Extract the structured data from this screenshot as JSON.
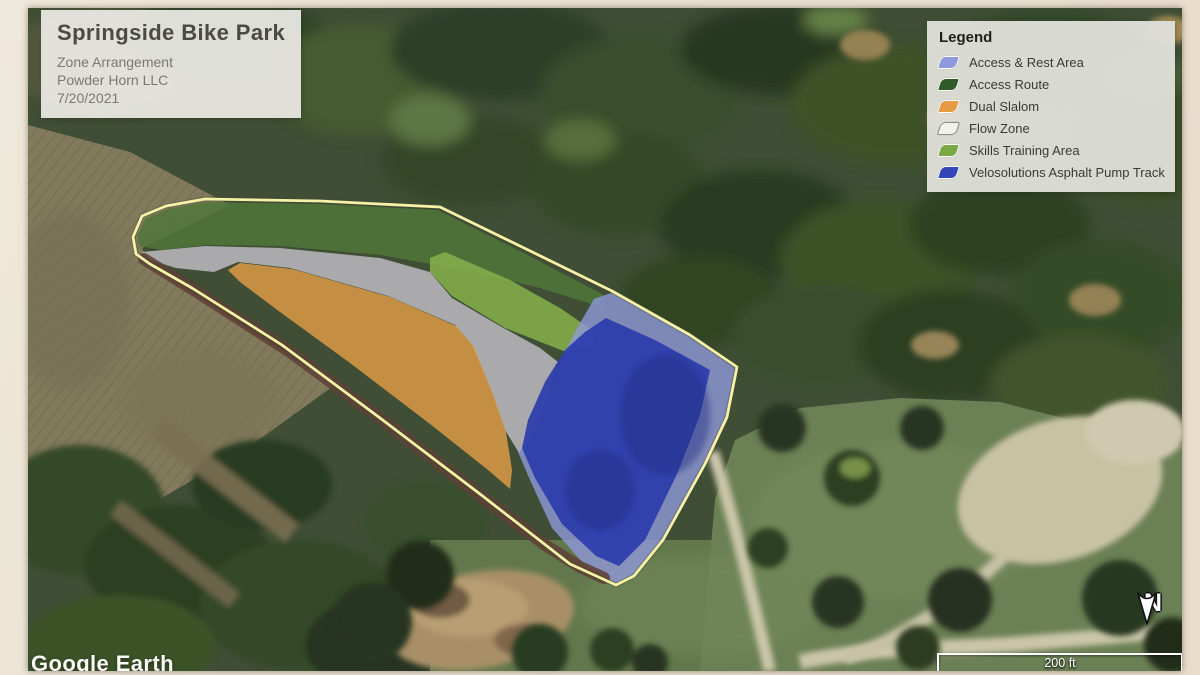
{
  "title_box": {
    "title": "Springside Bike Park",
    "lines": [
      "Zone Arrangement",
      "Powder Horn LLC",
      "7/20/2021"
    ]
  },
  "legend": {
    "title": "Legend",
    "items": [
      {
        "label": "Access & Rest Area",
        "color": "#8e99dd",
        "border": "#ffffff"
      },
      {
        "label": "Access Route",
        "color": "#2f5b28",
        "border": "#ffffff"
      },
      {
        "label": "Dual Slalom",
        "color": "#e59a43",
        "border": "#ffffff"
      },
      {
        "label": "Flow Zone",
        "color": "#f2f2ec",
        "border": "#8e8e88"
      },
      {
        "label": "Skills Training Area",
        "color": "#79a844",
        "border": "#ffffff"
      },
      {
        "label": "Velosolutions Asphalt Pump Track",
        "color": "#3347bb",
        "border": "#ffffff"
      }
    ]
  },
  "map": {
    "watermark": "Google Earth",
    "scale_label": "200 ft",
    "north_label": "N"
  },
  "zones": {
    "flow_zone": "#c6c2cc",
    "access_route": "#47702f",
    "skills": "#7fae42",
    "dual_slalom": "#e0993c",
    "access_rest": "#8a93d8",
    "pump_track": "#2132a8",
    "pump_track_dark": "#16227e",
    "berm": "#57362c",
    "outline": "#f5f1a2"
  }
}
